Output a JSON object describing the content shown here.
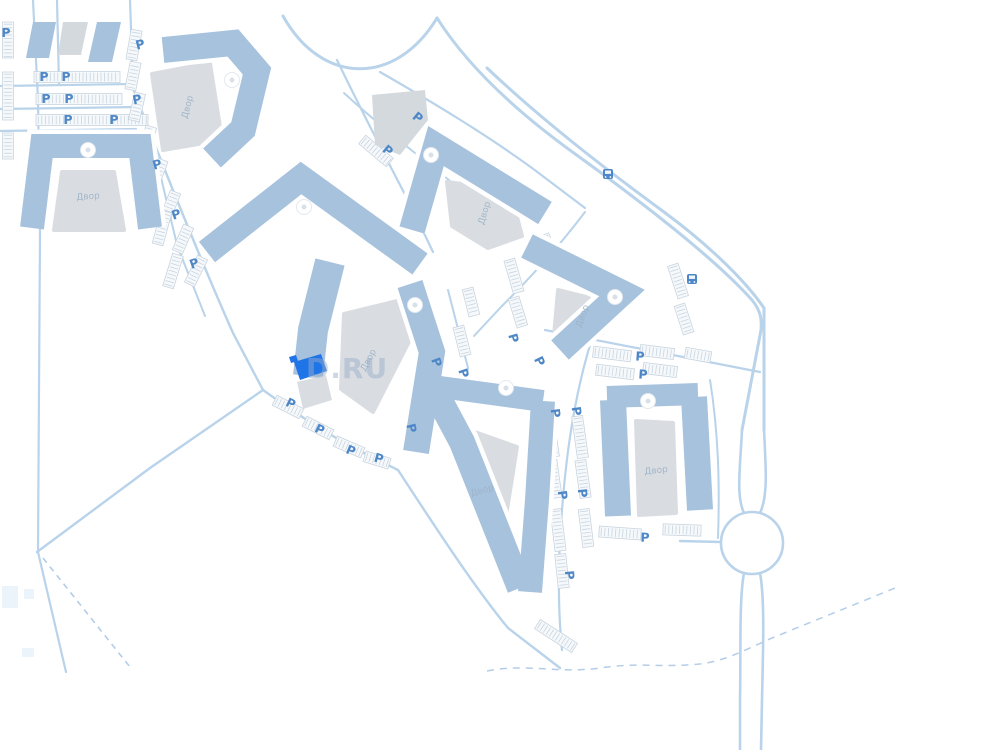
{
  "colors": {
    "band": "#a7c2dd",
    "gray": "#d9dde2",
    "grayb": "#d4d9de",
    "road": "#b9d3ea",
    "dashed": "#b3cde8",
    "stall": "#c9d4df",
    "stall_fill": "#f6f9fb",
    "p": "#4e87c7",
    "highlight": "#1f74e8",
    "circle_stroke": "#e2e9ef",
    "circle_inner": "#d8e0e8",
    "faint": "#e3eefa",
    "white": "#ffffff"
  },
  "watermark": {
    "text": "D.RU"
  },
  "p_label": "P",
  "map": {
    "roads": [
      [
        "M 33 0 L 38 100 L 40 230 L 38 552",
        2.2
      ],
      [
        "M 57 0 L 59 85",
        2.2
      ],
      [
        "M 0 86 L 133 84",
        2.2
      ],
      [
        "M 0 109 L 134 107",
        2.2
      ],
      [
        "M 0 131 L 136 129",
        2.2
      ],
      [
        "M 130 0 L 133 88",
        2.2
      ],
      [
        "M 133 88 C 162 165 205 270 233 333 L 263 390",
        2.4
      ],
      [
        "M 150 131 L 177 245 L 205 316",
        2
      ],
      [
        "M 37 552 L 150 468 L 263 390",
        2.4
      ],
      [
        "M 263 390 C 305 420 340 442 378 460 L 398 470 C 432 522 472 584 508 628 L 560 668",
        2.4
      ],
      [
        "M 38 552 L 52 612 L 66 672",
        2.2
      ],
      [
        "M 283 16 C 322 86 396 86 437 18",
        3
      ],
      [
        "M 380 72 C 432 102 484 133 532 168 L 585 208",
        2.2
      ],
      [
        "M 344 93 C 382 128 424 160 464 192 L 500 220",
        2
      ],
      [
        "M 437 18 C 470 70 522 116 578 156 C 650 208 718 262 752 300 C 760 310 762 318 761 330 L 742 430",
        3
      ],
      [
        "M 487 68 C 542 120 604 168 664 212 C 702 240 742 276 764 308 L 764 430",
        3
      ],
      [
        "M 742 430 C 740 470 736 496 744 513",
        2.6
      ],
      [
        "M 764 430 C 766 470 768 496 760 513",
        2.6
      ],
      [
        "M 744 573 C 739 600 741 650 740 700 L 740 750",
        2.6
      ],
      [
        "M 760 573 C 765 600 763 650 762 700 L 761 750",
        2.6
      ],
      [
        "M 680 541 L 721 542",
        2.4
      ],
      [
        "M 594 332 C 572 400 564 470 560 540 C 558 580 559 620 562 650",
        2.2
      ],
      [
        "M 545 330 C 620 345 700 360 760 372",
        2.2
      ],
      [
        "M 710 380 C 718 430 720 480 718 538",
        2
      ],
      [
        "M 337 60 C 362 112 388 162 412 208 L 433 252",
        2.2
      ],
      [
        "M 448 290 L 468 368 L 452 462",
        2
      ],
      [
        "M 585 212 C 558 248 530 278 502 306 L 474 336",
        2
      ]
    ],
    "dashed": [
      [
        "M 43 558 L 130 667",
        1.6,
        "6 5"
      ],
      [
        "M 487 671 C 525 663 560 674 600 668 C 640 662 660 668 700 664 C 725 661 745 650 772 638 L 900 586",
        1.5,
        "7 6"
      ]
    ],
    "roundabout": {
      "cx": 752,
      "cy": 543,
      "r": 31,
      "w": 2.6
    },
    "faint_rects": [
      [
        2,
        586,
        16,
        22
      ],
      [
        24,
        589,
        10,
        10
      ],
      [
        22,
        648,
        12,
        9
      ]
    ],
    "stall_rows": [
      [
        77,
        77,
        86,
        0
      ],
      [
        79,
        99,
        86,
        0
      ],
      [
        92,
        120,
        112,
        0
      ],
      [
        8,
        40,
        36,
        90
      ],
      [
        8,
        96,
        48,
        90
      ],
      [
        8,
        146,
        26,
        90
      ],
      [
        134,
        45,
        30,
        -80
      ],
      [
        133,
        76,
        28,
        -79
      ],
      [
        137,
        107,
        28,
        -77
      ],
      [
        147,
        141,
        30,
        -73
      ],
      [
        158,
        173,
        28,
        -70
      ],
      [
        170,
        206,
        30,
        -68
      ],
      [
        183,
        239,
        28,
        -66
      ],
      [
        196,
        271,
        30,
        -64
      ],
      [
        162,
        228,
        34,
        -75
      ],
      [
        173,
        271,
        34,
        -73
      ],
      [
        288,
        407,
        30,
        27
      ],
      [
        318,
        428,
        30,
        27
      ],
      [
        349,
        447,
        30,
        23
      ],
      [
        377,
        460,
        26,
        17
      ],
      [
        404,
        116,
        36,
        38
      ],
      [
        376,
        151,
        36,
        40
      ],
      [
        430,
        341,
        26,
        68
      ],
      [
        447,
        394,
        26,
        72
      ],
      [
        462,
        341,
        30,
        76
      ],
      [
        471,
        302,
        28,
        76
      ],
      [
        551,
        436,
        42,
        82
      ],
      [
        554,
        479,
        38,
        82
      ],
      [
        558,
        530,
        42,
        83
      ],
      [
        562,
        571,
        34,
        84
      ],
      [
        580,
        437,
        42,
        82
      ],
      [
        583,
        479,
        38,
        82
      ],
      [
        586,
        528,
        38,
        83
      ],
      [
        514,
        276,
        34,
        74
      ],
      [
        518,
        312,
        30,
        73
      ],
      [
        678,
        281,
        34,
        72
      ],
      [
        684,
        319,
        30,
        72
      ],
      [
        612,
        354,
        38,
        7
      ],
      [
        657,
        352,
        34,
        7
      ],
      [
        698,
        355,
        26,
        10
      ],
      [
        615,
        372,
        38,
        7
      ],
      [
        660,
        370,
        34,
        7
      ],
      [
        620,
        533,
        42,
        4
      ],
      [
        682,
        530,
        38,
        2
      ],
      [
        556,
        636,
        44,
        33
      ],
      [
        548,
        247,
        26,
        70
      ]
    ],
    "courtyards": [
      {
        "pts": [
          [
            62,
            172
          ],
          [
            114,
            172
          ],
          [
            124,
            230
          ],
          [
            54,
            230
          ]
        ],
        "label": {
          "t": "Двор",
          "x": 88,
          "y": 196,
          "r": -4
        }
      },
      {
        "pts": [
          [
            152,
            74
          ],
          [
            210,
            63
          ],
          [
            222,
            140
          ],
          [
            163,
            150
          ]
        ],
        "label": {
          "t": "Двор",
          "x": 187,
          "y": 107,
          "r": -75
        }
      },
      {
        "pts": [
          [
            447,
            182
          ],
          [
            510,
            190
          ],
          [
            522,
            236
          ],
          [
            488,
            248
          ],
          [
            452,
            226
          ]
        ],
        "label": {
          "t": "Двор",
          "x": 484,
          "y": 213,
          "r": -73
        }
      },
      {
        "pts": [
          [
            344,
            314
          ],
          [
            397,
            301
          ],
          [
            415,
            330
          ],
          [
            373,
            412
          ],
          [
            341,
            389
          ]
        ],
        "label": {
          "t": "Двор",
          "x": 368,
          "y": 360,
          "r": -62
        }
      },
      {
        "pts": [
          [
            558,
            290
          ],
          [
            610,
            303
          ],
          [
            602,
            333
          ],
          [
            554,
            336
          ]
        ],
        "label": {
          "t": "Двор",
          "x": 582,
          "y": 316,
          "r": -70
        }
      },
      {
        "pts": [
          [
            452,
            424
          ],
          [
            517,
            447
          ],
          [
            499,
            560
          ]
        ],
        "label": {
          "t": "Двор",
          "x": 482,
          "y": 490,
          "r": -16
        }
      },
      {
        "pts": [
          [
            636,
            421
          ],
          [
            673,
            423
          ],
          [
            676,
            513
          ],
          [
            639,
            515
          ]
        ],
        "label": {
          "t": "Двор",
          "x": 656,
          "y": 470,
          "r": -6
        }
      }
    ],
    "bands": [
      {
        "pts": [
          [
            32,
            228
          ],
          [
            42,
            146
          ],
          [
            140,
            146
          ],
          [
            150,
            228
          ]
        ],
        "w": 24
      },
      {
        "pts": [
          [
            163,
            50
          ],
          [
            233,
            43
          ],
          [
            257,
            71
          ],
          [
            243,
            129
          ],
          [
            212,
            158
          ]
        ],
        "w": 26
      },
      {
        "pts": [
          [
            412,
            230
          ],
          [
            436,
            146
          ],
          [
            545,
            213
          ]
        ],
        "w": 26
      },
      {
        "pts": [
          [
            207,
            252
          ],
          [
            301,
            178
          ],
          [
            420,
            264
          ]
        ],
        "w": 26
      },
      {
        "pts": [
          [
            330,
            262
          ],
          [
            313,
            330
          ],
          [
            308,
            376
          ]
        ],
        "w": 30
      },
      {
        "pts": [
          [
            410,
            284
          ],
          [
            432,
            352
          ],
          [
            416,
            452
          ]
        ],
        "w": 26
      },
      {
        "pts": [
          [
            430,
            382
          ],
          [
            462,
            442
          ],
          [
            520,
            588
          ]
        ],
        "w": 26
      },
      {
        "pts": [
          [
            440,
            387
          ],
          [
            543,
            401
          ]
        ],
        "w": 22
      },
      {
        "pts": [
          [
            543,
            401
          ],
          [
            537,
            500
          ],
          [
            530,
            592
          ]
        ],
        "w": 24
      },
      {
        "pts": [
          [
            613,
            400
          ],
          [
            618,
            516
          ]
        ],
        "w": 26
      },
      {
        "pts": [
          [
            607,
            397
          ],
          [
            698,
            394
          ]
        ],
        "w": 22
      },
      {
        "pts": [
          [
            694,
            397
          ],
          [
            700,
            510
          ]
        ],
        "w": 26
      },
      {
        "pts": [
          [
            527,
            246
          ],
          [
            622,
            293
          ],
          [
            560,
            350
          ]
        ],
        "w": 26
      }
    ],
    "solids": [
      {
        "pts": [
          [
            33,
            22
          ],
          [
            56,
            22
          ],
          [
            49,
            58
          ],
          [
            26,
            58
          ]
        ],
        "fill": "band"
      },
      {
        "pts": [
          [
            63,
            22
          ],
          [
            88,
            22
          ],
          [
            81,
            55
          ],
          [
            58,
            55
          ]
        ],
        "fill": "grayb"
      },
      {
        "pts": [
          [
            97,
            22
          ],
          [
            121,
            22
          ],
          [
            112,
            62
          ],
          [
            88,
            62
          ]
        ],
        "fill": "band"
      },
      {
        "pts": [
          [
            372,
            95
          ],
          [
            425,
            90
          ],
          [
            428,
            120
          ],
          [
            400,
            155
          ],
          [
            375,
            145
          ]
        ],
        "fill": "grayb"
      }
    ],
    "post_solids": [
      {
        "pts": [
          [
            297,
            382
          ],
          [
            326,
            375
          ],
          [
            332,
            400
          ],
          [
            303,
            409
          ]
        ],
        "fill": "gray"
      }
    ],
    "highlight": {
      "pts": [
        [
          294,
          362
        ],
        [
          321,
          354
        ],
        [
          327,
          371
        ],
        [
          300,
          380
        ]
      ],
      "flag": [
        [
          289,
          357
        ],
        [
          296,
          355
        ],
        [
          298,
          361
        ],
        [
          291,
          363
        ]
      ]
    },
    "circles": [
      [
        88,
        150
      ],
      [
        232,
        80
      ],
      [
        431,
        155
      ],
      [
        304,
        207
      ],
      [
        415,
        305
      ],
      [
        506,
        388
      ],
      [
        615,
        297
      ],
      [
        648,
        401
      ]
    ],
    "p_markers": [
      [
        6,
        32,
        0
      ],
      [
        44,
        76,
        0
      ],
      [
        66,
        76,
        0
      ],
      [
        46,
        98,
        0
      ],
      [
        69,
        98,
        0
      ],
      [
        68,
        119,
        0
      ],
      [
        114,
        119,
        0
      ],
      [
        140,
        44,
        -14
      ],
      [
        137,
        99,
        -12
      ],
      [
        157,
        164,
        -16
      ],
      [
        176,
        214,
        -18
      ],
      [
        194,
        263,
        -20
      ],
      [
        291,
        403,
        26
      ],
      [
        320,
        429,
        26
      ],
      [
        351,
        450,
        22
      ],
      [
        379,
        458,
        16
      ],
      [
        418,
        117,
        40
      ],
      [
        388,
        150,
        40
      ],
      [
        437,
        362,
        70
      ],
      [
        464,
        373,
        72
      ],
      [
        412,
        428,
        76
      ],
      [
        556,
        413,
        82
      ],
      [
        577,
        411,
        82
      ],
      [
        563,
        495,
        83
      ],
      [
        583,
        493,
        84
      ],
      [
        570,
        575,
        85
      ],
      [
        514,
        338,
        74
      ],
      [
        540,
        361,
        64
      ],
      [
        640,
        356,
        4
      ],
      [
        643,
        374,
        4
      ],
      [
        645,
        537,
        2
      ]
    ],
    "bus_stops": [
      [
        608,
        174
      ],
      [
        692,
        279
      ]
    ]
  }
}
